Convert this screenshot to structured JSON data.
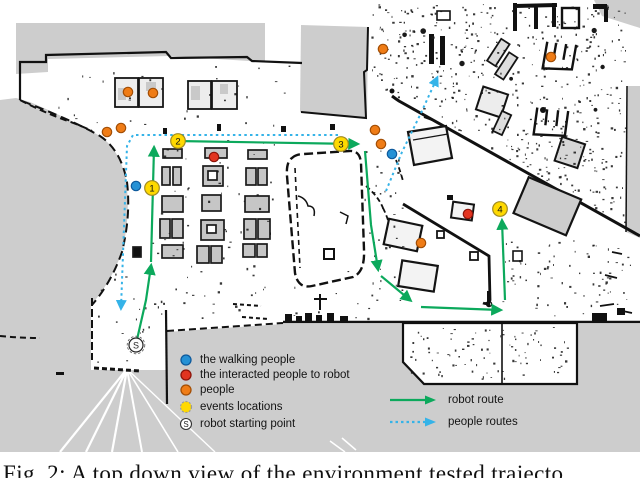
{
  "caption": "Fig. 2: A top down view of the environment tested trajecto",
  "legend": {
    "items": [
      {
        "label": "the walking people",
        "color": "#2591d5"
      },
      {
        "label": "the interacted people to robot",
        "color": "#e23420"
      },
      {
        "label": "people",
        "color": "#ef7c16"
      },
      {
        "label": "events locations",
        "color": "#ffd900"
      },
      {
        "label": "robot starting point",
        "color": "#ffffff",
        "symbol": "S"
      }
    ],
    "routes": [
      {
        "label": "robot route",
        "style": "solid",
        "color": "#0ca95c"
      },
      {
        "label": "people routes",
        "style": "dotted",
        "color": "#35b3e8"
      }
    ]
  },
  "colors": {
    "free_space": "#ffffff",
    "unknown_space": "#cdcdcd",
    "wall": "#111111",
    "robot_route": "#0ca95c",
    "people_route": "#35b3e8",
    "event": "#ffd900",
    "walking": "#2591d5",
    "interacted": "#e23420",
    "person": "#ef7c16"
  },
  "map": {
    "events": [
      {
        "number": "1",
        "x": 152,
        "y": 188
      },
      {
        "number": "2",
        "x": 178,
        "y": 141
      },
      {
        "number": "3",
        "x": 341,
        "y": 144
      },
      {
        "number": "4",
        "x": 500,
        "y": 209
      }
    ],
    "start": {
      "symbol": "S",
      "x": 136,
      "y": 345
    },
    "walking_people": [
      [
        136,
        186
      ],
      [
        392,
        154
      ]
    ],
    "interacted_people": [
      [
        214,
        157
      ],
      [
        468,
        214
      ]
    ],
    "people": [
      [
        128,
        92
      ],
      [
        153,
        93
      ],
      [
        107,
        132
      ],
      [
        121,
        128
      ],
      [
        375,
        130
      ],
      [
        381,
        144
      ],
      [
        383,
        49
      ],
      [
        421,
        243
      ],
      [
        551,
        57
      ]
    ],
    "robot_route": [
      [
        [
          136,
          344
        ],
        [
          146,
          300
        ],
        [
          151,
          266
        ]
      ],
      [
        [
          151,
          262
        ],
        [
          154,
          148
        ]
      ],
      [
        [
          176,
          141
        ],
        [
          357,
          144
        ]
      ],
      [
        [
          365,
          151
        ],
        [
          371,
          225
        ],
        [
          378,
          269
        ]
      ],
      [
        [
          381,
          276
        ],
        [
          410,
          300
        ]
      ],
      [
        [
          421,
          307
        ],
        [
          500,
          310
        ]
      ],
      [
        [
          505,
          300
        ],
        [
          502,
          221
        ]
      ]
    ],
    "people_routes": [
      [
        [
          338,
          135
        ],
        [
          133,
          135
        ],
        [
          127,
          146
        ],
        [
          121,
          308
        ]
      ],
      [
        [
          386,
          191
        ],
        [
          402,
          152
        ],
        [
          421,
          113
        ],
        [
          437,
          78
        ]
      ]
    ]
  }
}
